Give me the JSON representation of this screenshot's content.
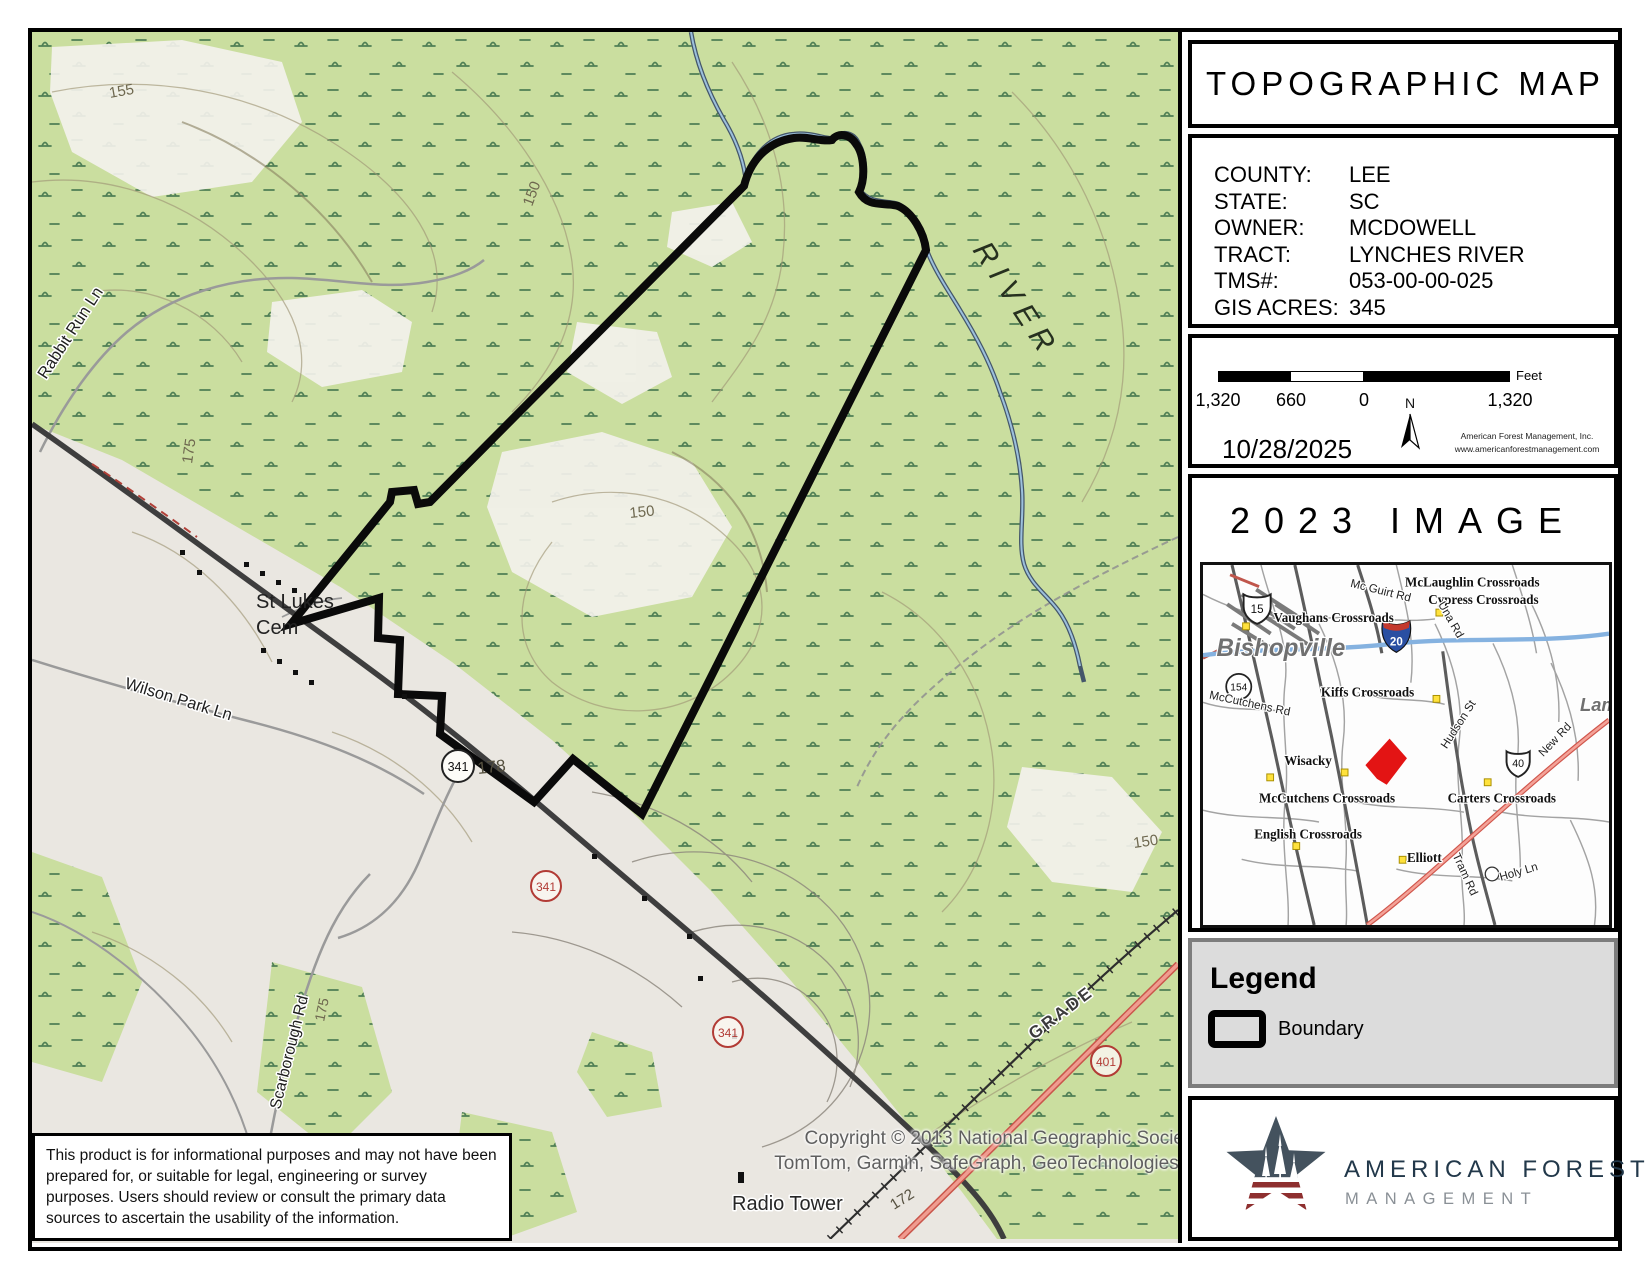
{
  "map": {
    "road_labels": {
      "rabbit_run": "Rabbit Run Ln",
      "wilson_park": "Wilson Park Ln",
      "scarborough": "Scarborough Rd",
      "grade": "GRADE",
      "river": "RIVER",
      "radio_tower": "Radio Tower",
      "st_lukes_line1": "St Lukes",
      "st_lukes_line2": "Cem"
    },
    "elevations": {
      "e155": "155",
      "e150a": "150",
      "e175a": "175",
      "e150b": "150",
      "e178": "178",
      "e150c": "150",
      "e172": "172",
      "e175b": "175"
    },
    "shields": {
      "s341a": "341",
      "s341b": "341",
      "s341c": "341",
      "s401": "401"
    },
    "disclaimer": "This product is for informational purposes and may not have been prepared for, or suitable for legal, engineering or survey purposes.  Users should review or consult the primary data sources to ascertain the usability of the information.",
    "copyright_line1": "Copyright © 2013 National Geographic Socie",
    "copyright_line2": "TomTom, Garmin, SafeGraph, GeoTechnologies,"
  },
  "sidebar": {
    "title": "TOPOGRAPHIC MAP",
    "info_rows": [
      {
        "label": "COUNTY:",
        "value": "LEE"
      },
      {
        "label": "STATE:",
        "value": "SC"
      },
      {
        "label": "OWNER:",
        "value": "MCDOWELL"
      },
      {
        "label": "TRACT:",
        "value": "LYNCHES RIVER"
      },
      {
        "label": "TMS#:",
        "value": "053-00-00-025"
      },
      {
        "label": "GIS ACRES:",
        "value": "345"
      }
    ],
    "scalebar": {
      "tick_left": "1,320",
      "tick_mid": "660",
      "tick_zero": "0",
      "tick_right": "1,320",
      "unit": "Feet"
    },
    "date": "10/28/2025",
    "north_label": "N",
    "company_line1": "American Forest Management, Inc.",
    "company_line2": "www.americanforestmanagement.com",
    "image_header": "2023 IMAGE",
    "inset": {
      "cities": {
        "bishopville": "Bishopville",
        "lamar": "Lamar"
      },
      "places": {
        "mclaughlin": "McLaughlin Crossroads",
        "cypress": "Cypress Crossroads",
        "vaughans": "Vaughans Crossroads",
        "kiffs": "Kiffs Crossroads",
        "wisacky": "Wisacky",
        "mccutchens_x": "McCutchens Crossroads",
        "carters": "Carters Crossroads",
        "english": "English Crossroads",
        "elliott": "Elliott"
      },
      "roads": {
        "mc_guirt": "Mc Guirt Rd",
        "mccutchens_rd": "McCutchens Rd",
        "hudson": "Hudson St",
        "una": "Una Rd",
        "new_rd": "New Rd",
        "tram": "Tram Rd",
        "holy": "Holy Ln"
      },
      "shields": {
        "us15": "15",
        "sc154": "154",
        "i20": "20",
        "us40": "40"
      }
    },
    "legend": {
      "heading": "Legend",
      "boundary_label": "Boundary"
    },
    "logo": {
      "line1": "AMERICAN FOREST",
      "line2": "MANAGEMENT"
    }
  },
  "colors": {
    "forest_green": "#cade9f",
    "open_gray": "#eae7e1",
    "boundary_black": "#0a0a0a",
    "river_blue": "#9cc0dc",
    "highway_salmon": "#f09c90",
    "interstate_blue": "#2a4fa2",
    "interstate_red": "#c4392e",
    "marker_red": "#e31414",
    "crossroad_yellow": "#ffe23d",
    "logo_slate": "#44525e",
    "logo_red": "#8e2f2f"
  }
}
